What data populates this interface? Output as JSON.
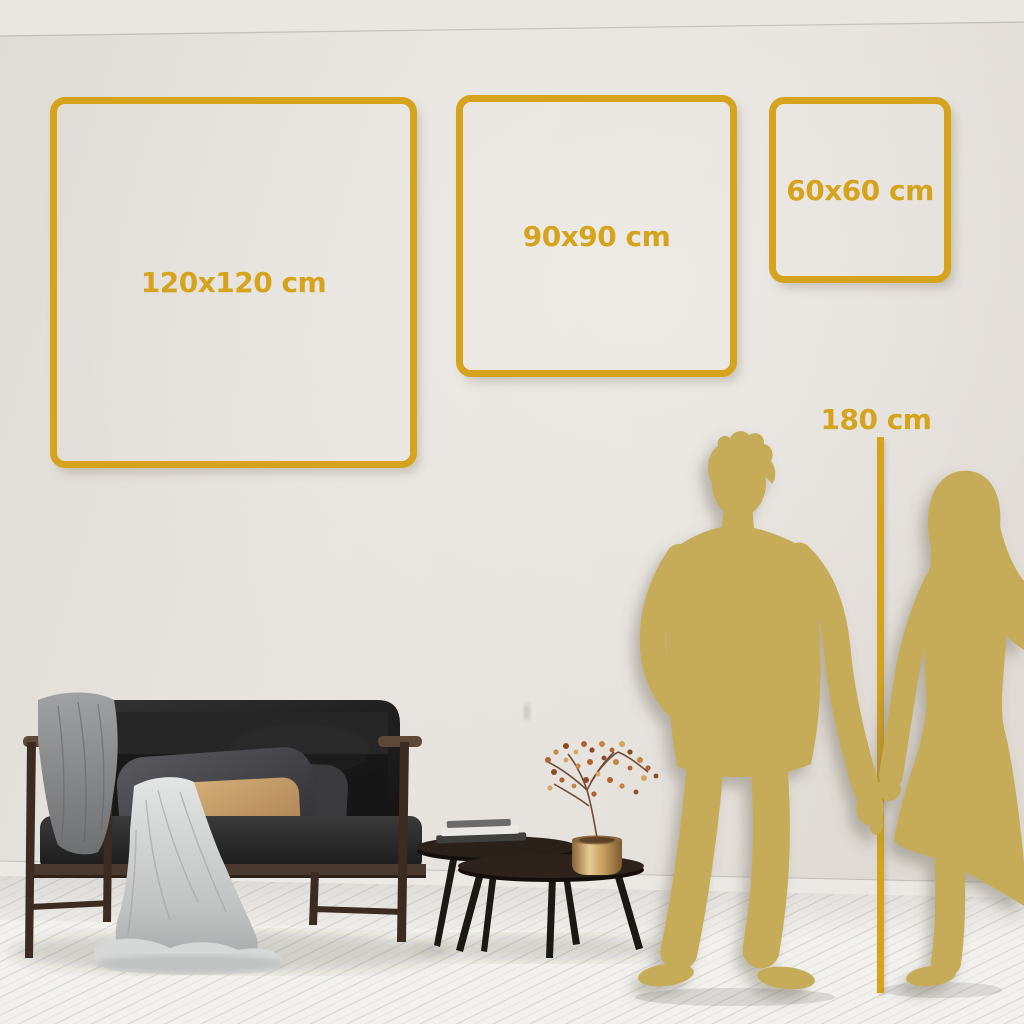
{
  "colors": {
    "accent_gold": "#D6A31C",
    "silhouette_gold": "#C6AC58",
    "wall": "#E5E2DD",
    "floor": "#F2F1EE"
  },
  "size_frames": [
    {
      "label": "120x120 cm",
      "size_cm": 120
    },
    {
      "label": "90x90 cm",
      "size_cm": 90
    },
    {
      "label": "60x60 cm",
      "size_cm": 60
    }
  ],
  "height_marker": {
    "label": "180 cm",
    "height_cm": 180
  },
  "scene_elements": [
    "man-silhouette",
    "woman-silhouette",
    "height-reference-line",
    "sofa",
    "throw-blanket",
    "draped-cloth",
    "gray-pillow",
    "tan-pillow",
    "nesting-coffee-tables",
    "books",
    "gold-vase",
    "dried-branch-with-berries",
    "wall",
    "baseboard",
    "wood-plank-floor"
  ]
}
